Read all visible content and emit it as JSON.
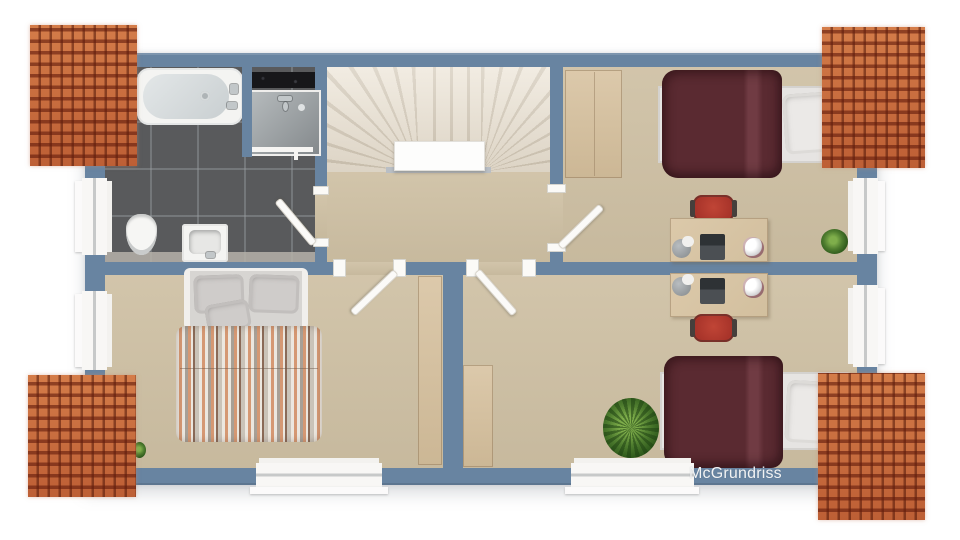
{
  "watermark": {
    "label": "McGrundriss"
  },
  "palette": {
    "wall": "#6884a1",
    "carpet": "#cfc1a5",
    "tile": "#595a5c",
    "stair_light": "#ece4d6",
    "stair_dark": "#d2c8b7",
    "bedframe": "#e6e4e2",
    "duvet": "#5a2a31",
    "duvet_light": "#703b43",
    "wood": "#dcc9ab",
    "wood_dark": "#ccb795",
    "chair": "#a8342a",
    "plant": "#4f7d2f",
    "plant_dark": "#2f5a1c",
    "roof_base": "#cb6f40",
    "stripe_cream": "#ece7df",
    "stripe_salmon": "#d59873",
    "stripe_gray": "#a8a096",
    "stripe_brown": "#8a6a57",
    "stripe_light": "#cac3b8",
    "text_white": "#f2f3f4"
  },
  "scene": {
    "rooms": [
      "bathroom",
      "staircase",
      "hallway",
      "bedroom-top-right",
      "bedroom-master",
      "bedroom-bottom-right"
    ],
    "furniture": [
      "bathtub",
      "shower",
      "toilet",
      "sink",
      "double-bed",
      "single-bed",
      "desk",
      "office-chair",
      "wardrobe",
      "plant",
      "laptop",
      "desk-lamp",
      "crumpled-paper"
    ]
  }
}
